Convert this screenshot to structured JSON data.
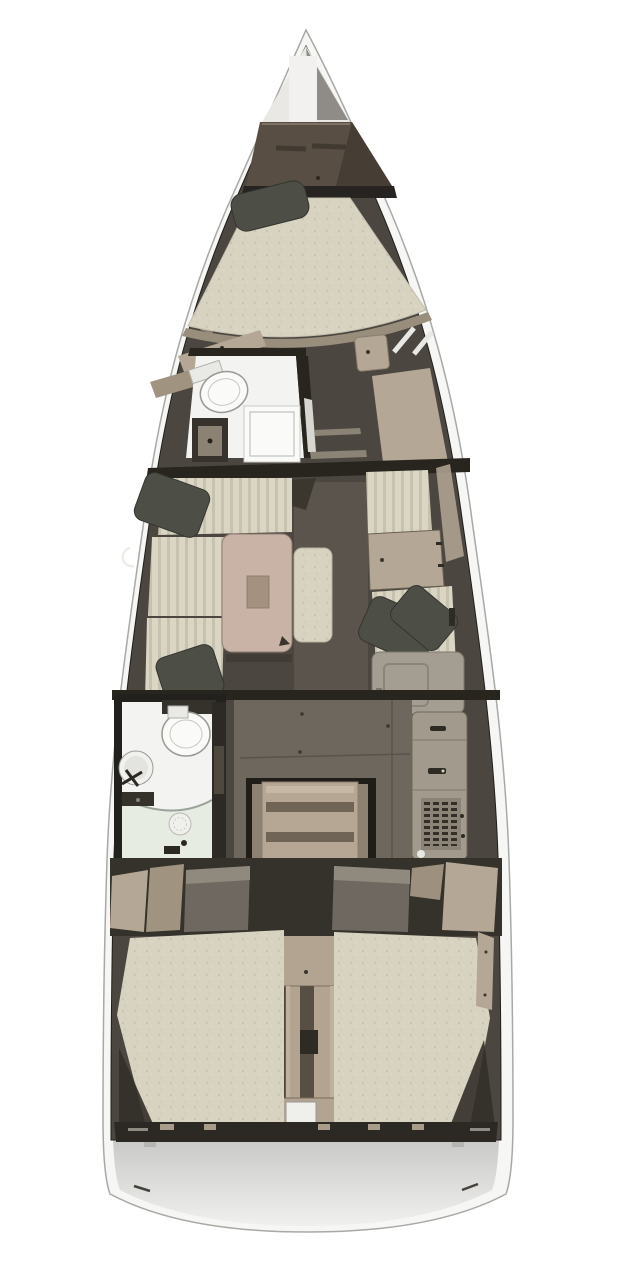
{
  "meta": {
    "title": "Sailing yacht interior floor plan — top view"
  },
  "colors": {
    "page_bg": "#ffffff",
    "hull_white": "#f6f6f4",
    "hull_stroke": "#a8a8a5",
    "interior_dark": "#4b4640",
    "wall_dark": "#28251f",
    "wood_light": "#b4a795",
    "wood_mid": "#a0937f",
    "wood_dark": "#8d8172",
    "locker_brown": "#584e43",
    "mattress_beige": "#d7d3c0",
    "mattress_fleck": "#c8c4b1",
    "cushion_beige": "#dad6c3",
    "cushion_stripe": "#c6c2af",
    "pillow_dark": "#4d4e46",
    "table_tan": "#c9b3a6",
    "table_inset": "#a5917f",
    "fixture_white": "#fafaf8",
    "floor_white": "#f3f4f1",
    "shower_tint": "#e7ece3",
    "gray_cabinet": "#a39d92",
    "galley_gray": "#a29a8c",
    "floor_mid": "#6e675d",
    "walkway": "#5a544c",
    "steps_tan": "#b6a795",
    "tread_dark": "#6f6455",
    "engine_tan": "#b3a492",
    "transom_top": "#c9c9c7",
    "transom_bottom": "#f0f0ee",
    "vent_dark": "#332f28",
    "band_dark": "#2c2925",
    "bow_shadow": "#8f8c87",
    "bow_white": "#e9e8e5"
  },
  "regions": {
    "hull": "Hull",
    "anchor_locker": "Anchor locker",
    "v_berth": "Forward cabin V-berth",
    "forward_head": "Forward head with toilet and shower",
    "wardrobe": "Hanging locker",
    "port_settee": "Saloon port settee",
    "saloon_table": "Saloon table",
    "center_bench": "Center bench seat",
    "starboard_settee": "Starboard settee and chart table",
    "galley": "Galley unit with refrigerator vent",
    "aft_head": "Aft head with sink, toilet and shower",
    "companionway": "Companionway steps",
    "engine_box": "Engine compartment",
    "port_aft_berth": "Port aft cabin berth",
    "starboard_aft_berth": "Starboard aft cabin berth",
    "transom": "Stern transom platform"
  }
}
